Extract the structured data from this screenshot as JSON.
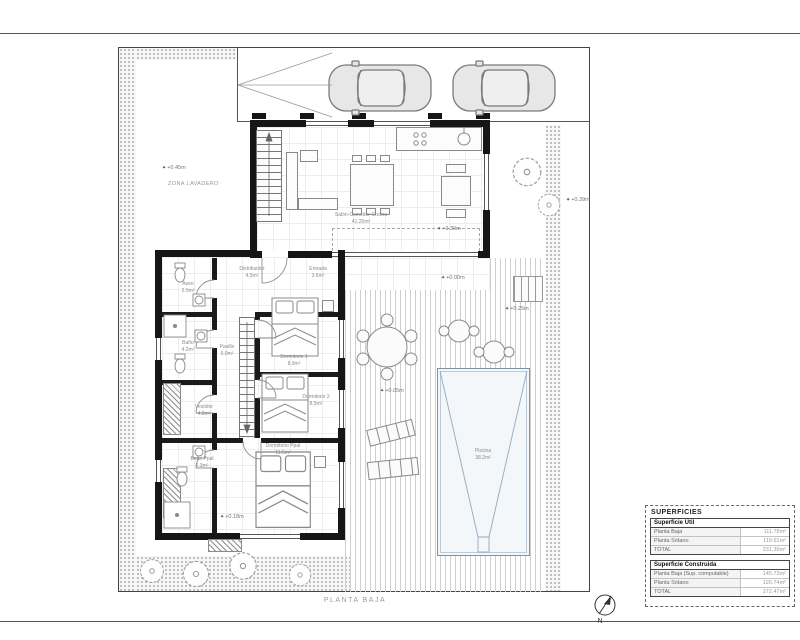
{
  "frame": {
    "plan_title": "PLANTA BAJA"
  },
  "icons": {
    "benchmark": "✦",
    "north_label": "N"
  },
  "garden": {
    "zona_lavadero": "ZONA LAVADERO"
  },
  "levels": {
    "lavadero": "+0.45m",
    "salon": "+0.30m",
    "porche": "+0.00m",
    "este": "+0.39m",
    "escalera": "+0.25m",
    "terraza": "+0.05m",
    "pasillo": "+0.18m"
  },
  "rooms": {
    "salon": {
      "name": "Salón-Comedor-Cocina",
      "area": "41.20m²"
    },
    "entrada": {
      "name": "Entrada",
      "area": "3.6m²"
    },
    "distribuidor": {
      "name": "Distribuidor",
      "area": "4.5m²"
    },
    "aseo": {
      "name": "Aseo",
      "area": "2.0m²"
    },
    "bano": {
      "name": "Baño",
      "area": "4.2m²"
    },
    "pasillo": {
      "name": "Pasillo",
      "area": "5.0m²"
    },
    "vestidor": {
      "name": "Vestidor",
      "area": "4.8m²"
    },
    "bano_ppal": {
      "name": "Baño Ppal",
      "area": "6.3m²"
    },
    "dormitorio1": {
      "name": "Dormitorio 1",
      "area": "8.9m²"
    },
    "dormitorio2": {
      "name": "Dormitorio 2",
      "area": "8.5m²"
    },
    "dormitorio_ppal": {
      "name": "Dormitorio Ppal",
      "area": "11.5m²"
    }
  },
  "pool": {
    "name": "Piscina",
    "area": "38.2m²"
  },
  "superficies": {
    "title": "SUPERFICIES",
    "util": {
      "header": "Superficie Útil",
      "rows": [
        {
          "label": "Planta Baja",
          "value": "111.78m²"
        },
        {
          "label": "Planta Sótano",
          "value": "119.61m²"
        },
        {
          "label": "TOTAL",
          "value": "231.39m²"
        }
      ]
    },
    "construida": {
      "header": "Superficie Construida",
      "rows": [
        {
          "label": "Planta Baja (Sup. computable)",
          "value": "145.73m²"
        },
        {
          "label": "Planta Sótano",
          "value": "126.74m²"
        },
        {
          "label": "TOTAL",
          "value": "272.47m²"
        }
      ]
    }
  }
}
